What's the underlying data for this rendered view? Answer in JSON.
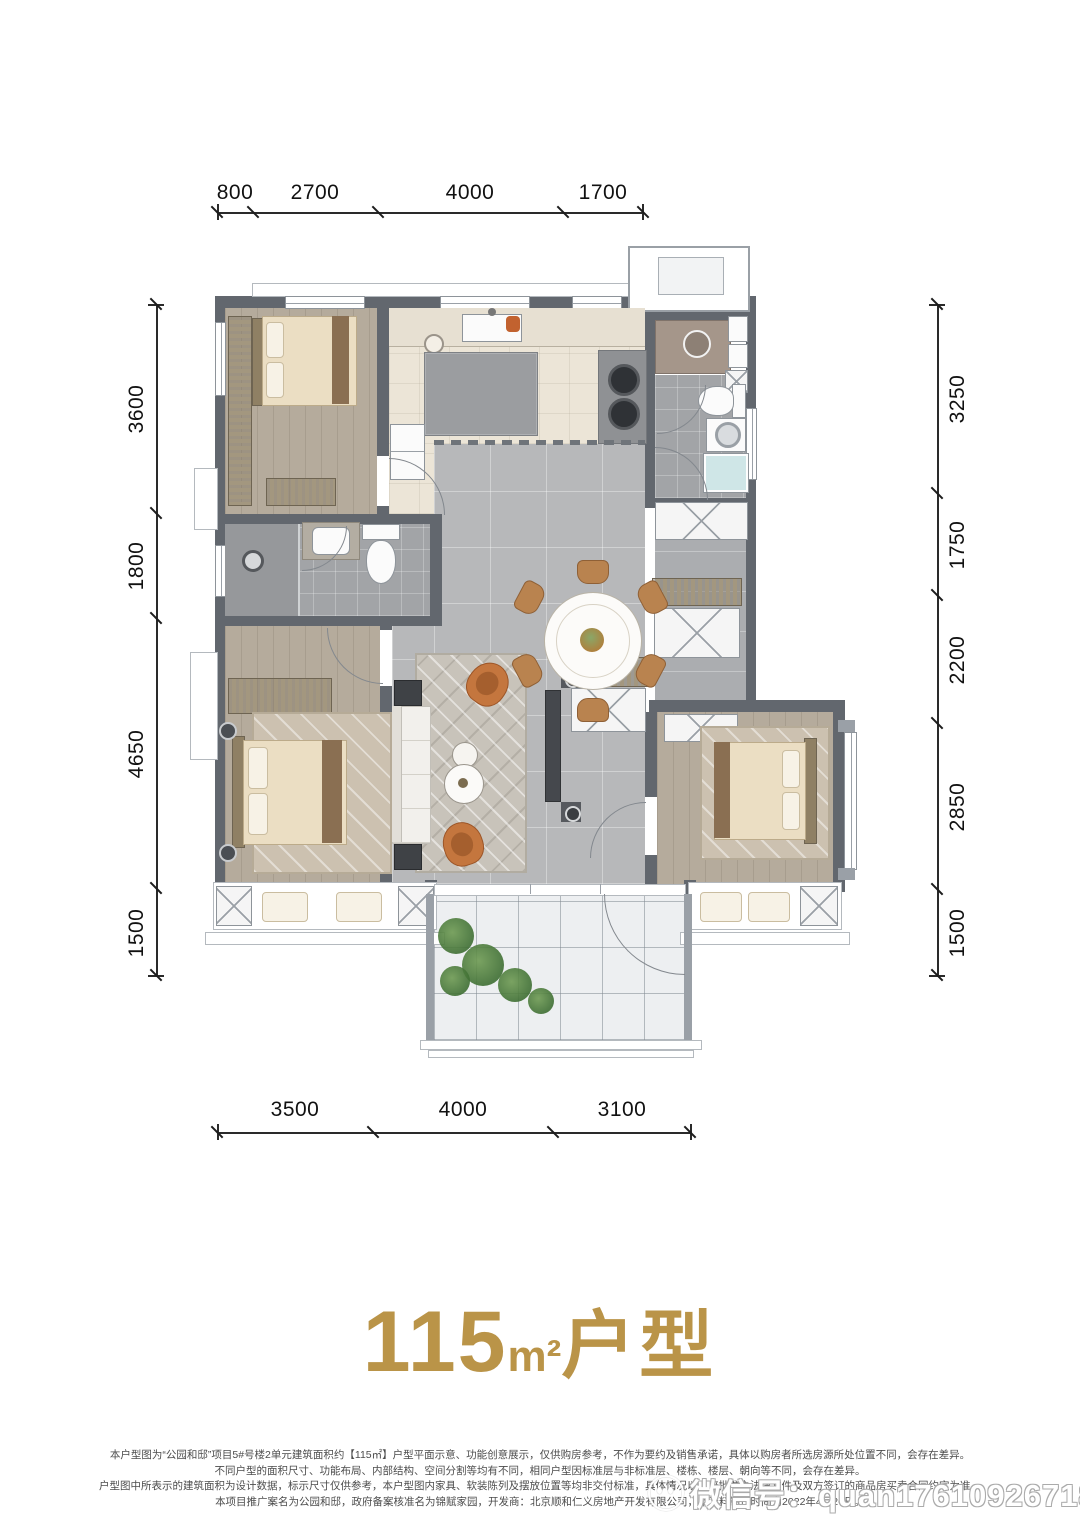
{
  "title": {
    "value": "115",
    "unit": "m²",
    "suffix": "户型"
  },
  "dimensions": {
    "top": [
      "800",
      "2700",
      "4000",
      "1700"
    ],
    "bottom": [
      "3500",
      "4000",
      "3100"
    ],
    "left": [
      "3600",
      "1800",
      "4650",
      "1500"
    ],
    "right": [
      "3250",
      "1750",
      "2200",
      "2850",
      "1500"
    ]
  },
  "disclaimer": {
    "line1": "本户型图为“公园和邸”项目5#号楼2单元建筑面积约【115㎡】户型平面示意、功能创意展示，仅供购房参考，不作为要约及销售承诺，具体以购房者所选房源所处位置不同，会存在差异。",
    "line2": "不同户型的面积尺寸、功能布局、内部结构、空间分割等均有不同，相同户型因标准层与非标准层、楼栋、楼层、朝向等不同，会存在差异。",
    "line3": "户型图中所表示的建筑面积为设计数据，标示尺寸仅供参考，本户型图内家具、软装陈列及摆放位置等均非交付标准，具体情况以政府批准之法律文件及双方签订的商品房买卖合同约定为准。",
    "line4": "本项目推广案名为公园和邸，政府备案核准名为锦赋家园，开发商：北京顺和仁义房地产开发有限公司，本资料制作时间为2022年4月26日。"
  },
  "watermark": {
    "text": "微信号：quan17610926718"
  },
  "colors": {
    "title_gold": "#ba9448",
    "wall_gray": "#62676e",
    "accent_orange": "#c4763e"
  }
}
